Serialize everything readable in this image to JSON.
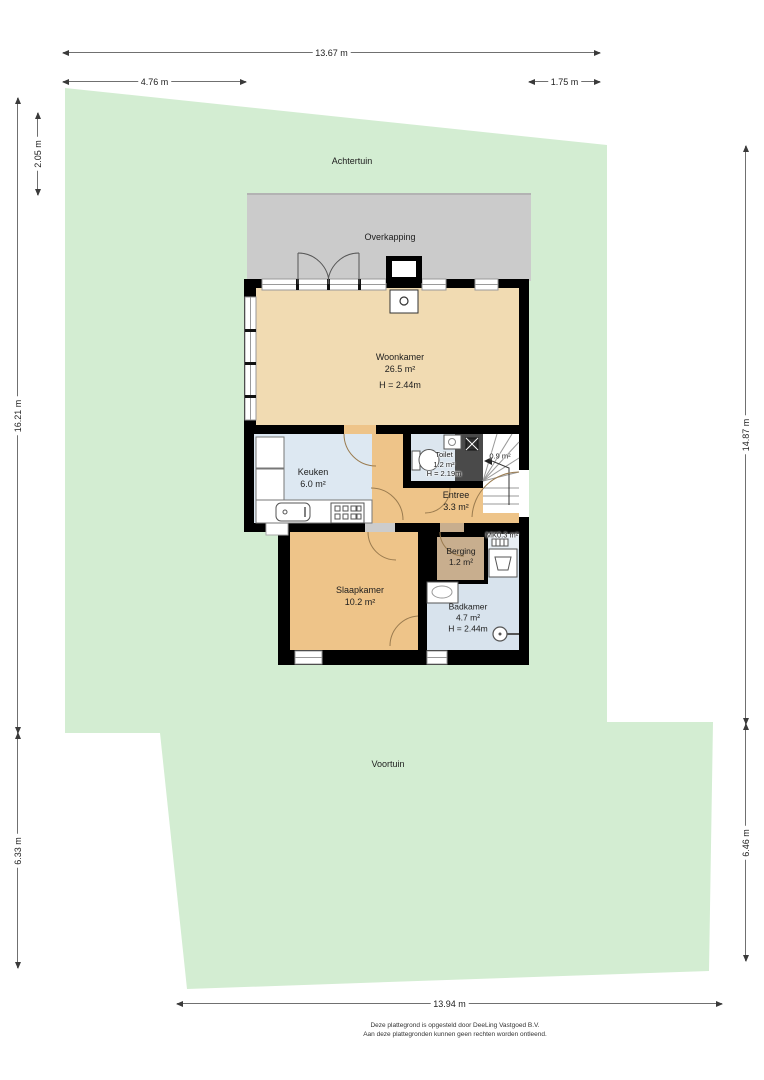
{
  "plan": {
    "outdoor": {
      "back_garden": "Achtertuin",
      "canopy": "Overkapping",
      "front_garden": "Voortuin"
    },
    "rooms": {
      "woonkamer": {
        "name": "Woonkamer",
        "area": "26.5 m²",
        "ceiling": "H = 2.44m"
      },
      "keuken": {
        "name": "Keuken",
        "area": "6.0 m²"
      },
      "toilet": {
        "name": "Toilet",
        "area": "1.2 m²",
        "ceiling": "H = 2.19m"
      },
      "trap": {
        "area": "0.9 m²"
      },
      "entree": {
        "name": "Entree",
        "area": "3.3 m²"
      },
      "mk": {
        "name": "MK",
        "area": "0.3 m²"
      },
      "berging": {
        "name": "Berging",
        "area": "1.2 m²"
      },
      "slaapkamer": {
        "name": "Slaapkamer",
        "area": "10.2 m²"
      },
      "badkamer": {
        "name": "Badkamer",
        "area": "4.7 m²",
        "ceiling": "H = 2.44m"
      }
    },
    "dimensions": {
      "top_total": "13.67 m",
      "top_left": "4.76 m",
      "top_right": "1.75 m",
      "left_inner": "2.05 m",
      "left_upper": "16.21 m",
      "left_lower": "6.33 m",
      "right_upper": "14.87 m",
      "right_lower": "6.46 m",
      "bottom": "13.94 m"
    },
    "footer": {
      "line1": "Deze plattegrond is opgesteld door DeeLing Vastgoed B.V.",
      "line2": "Aan deze plattegronden kunnen geen rechten worden ontleend."
    },
    "colors": {
      "garden_green": "#d3edd2",
      "canopy_gray": "#cbcbcb",
      "living_tan": "#f1dbb2",
      "bedroom_orange": "#eec489",
      "kitchen_blue": "#dde8f2",
      "bathroom_blue": "#d8e3ed",
      "storage_brown": "#c8ae8e",
      "wall_black": "#000000",
      "void_gray": "#4a4a4a"
    }
  }
}
